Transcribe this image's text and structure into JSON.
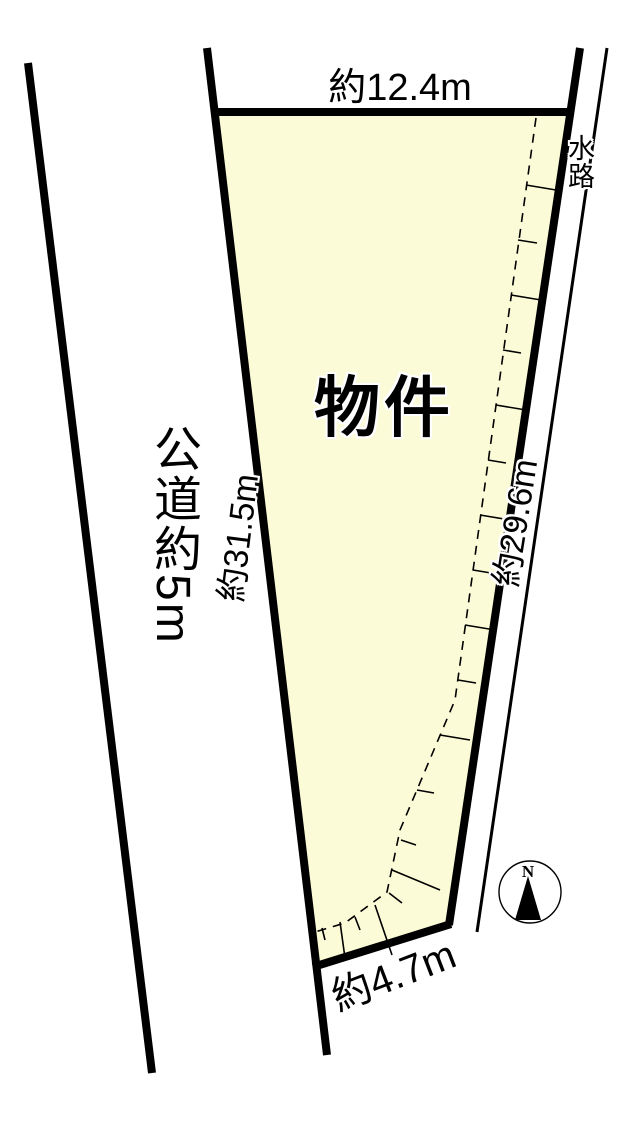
{
  "diagram": {
    "property_label": "物件",
    "road_label": "公道約5m",
    "waterway_label": "水路",
    "compass_north_label": "N",
    "dimensions": {
      "top_width": "約12.4m",
      "left_depth": "約31.5m",
      "right_depth": "約29.6m",
      "bottom_frontage": "約4.7m"
    },
    "colors": {
      "plot-fill": "#FBFBD7",
      "line": "#000000",
      "background": "#FFFFFF"
    }
  }
}
